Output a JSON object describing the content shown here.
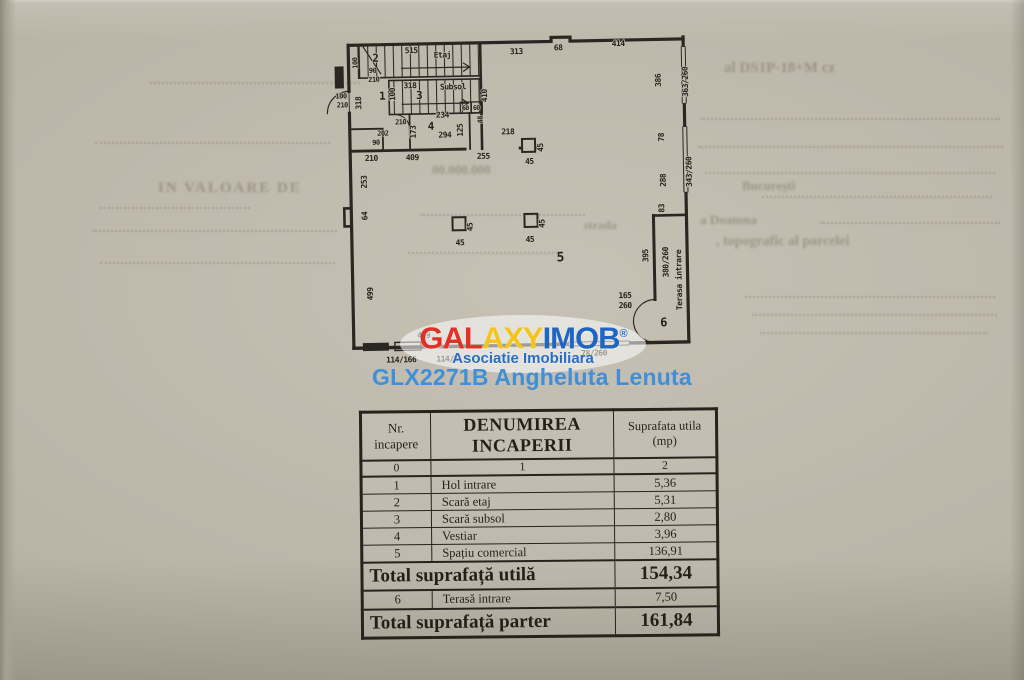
{
  "colors": {
    "paper": "#bcb6a9",
    "ink": "#26231d",
    "logo_gal": "#e03127",
    "logo_axy": "#f2c41d",
    "logo_imob": "#1f66c2",
    "tagline_blue": "#2b6cc4",
    "listing_blue": "#3f8fd9"
  },
  "watermark": {
    "logo_gal": "GAL",
    "logo_axy": "AXY",
    "logo_imob": "IMOB",
    "logo_reg": "®",
    "tagline": "Asociatie Imobiliara",
    "listing": "GLX2271B Angheluta Lenuta"
  },
  "table": {
    "headers": [
      "Nr.\nincapere",
      "DENUMIREA\nINCAPERII",
      "Suprafata utila\n(mp)"
    ],
    "index_row": [
      "0",
      "1",
      "2"
    ],
    "rows": [
      [
        "1",
        "Hol intrare",
        "5,36"
      ],
      [
        "2",
        "Scară etaj",
        "5,31"
      ],
      [
        "3",
        "Scară subsol",
        "2,80"
      ],
      [
        "4",
        "Vestiar",
        "3,96"
      ],
      [
        "5",
        "Spațiu comercial",
        "136,91"
      ]
    ],
    "total_utila": {
      "label": "Total suprafață utilă",
      "value": "154,34"
    },
    "terasa_row": [
      "6",
      "Terasă intrare",
      "7,50"
    ],
    "total_parter": {
      "label": "Total suprafață parter",
      "value": "161,84"
    }
  },
  "plan": {
    "labels": [
      {
        "t": "313",
        "x": 183,
        "y": 36
      },
      {
        "t": "68",
        "x": 225,
        "y": 33
      },
      {
        "t": "414",
        "x": 285,
        "y": 30
      },
      {
        "t": "386",
        "x": 327,
        "y": 65,
        "r": -90
      },
      {
        "t": "363/260",
        "x": 354,
        "y": 67,
        "r": -90
      },
      {
        "t": "78",
        "x": 329,
        "y": 122,
        "r": -90
      },
      {
        "t": "343/260",
        "x": 356,
        "y": 157,
        "r": -90
      },
      {
        "t": "288",
        "x": 330,
        "y": 165,
        "r": -90
      },
      {
        "t": "83",
        "x": 328,
        "y": 193,
        "r": -90
      },
      {
        "t": "395",
        "x": 311,
        "y": 240,
        "r": -90
      },
      {
        "t": "380/260",
        "x": 331,
        "y": 247,
        "r": -90
      },
      {
        "t": "Terasa intrare",
        "x": 344,
        "y": 265,
        "r": -90
      },
      {
        "t": "6",
        "x": 325,
        "y": 311,
        "s": 12
      },
      {
        "t": "165",
        "x": 287,
        "y": 282
      },
      {
        "t": "260",
        "x": 287,
        "y": 292
      },
      {
        "t": "5",
        "x": 223,
        "y": 244,
        "s": 13
      },
      {
        "t": "45",
        "x": 123,
        "y": 226
      },
      {
        "t": "45",
        "x": 136,
        "y": 208,
        "r": -90
      },
      {
        "t": "45",
        "x": 193,
        "y": 224
      },
      {
        "t": "45",
        "x": 208,
        "y": 206,
        "r": -90
      },
      {
        "t": "45",
        "x": 194,
        "y": 146
      },
      {
        "t": "45",
        "x": 208,
        "y": 130,
        "r": -90
      },
      {
        "t": "218",
        "x": 173,
        "y": 116
      },
      {
        "t": "255",
        "x": 148,
        "y": 140
      },
      {
        "t": "409",
        "x": 77,
        "y": 140
      },
      {
        "t": "210",
        "x": 36,
        "y": 140
      },
      {
        "t": "409",
        "x": 85,
        "y": 318
      },
      {
        "t": "253",
        "x": 31,
        "y": 161,
        "r": -90
      },
      {
        "t": "64",
        "x": 31,
        "y": 195,
        "r": -90
      },
      {
        "t": "499",
        "x": 35,
        "y": 273,
        "r": -90
      },
      {
        "t": "114/166",
        "x": 62,
        "y": 342
      },
      {
        "t": "114/1",
        "x": 108,
        "y": 342
      },
      {
        "t": "78/260",
        "x": 255,
        "y": 339
      },
      {
        "t": "410",
        "x": 153,
        "y": 77,
        "r": -90
      },
      {
        "t": "515",
        "x": 78,
        "y": 33
      },
      {
        "t": "Etaj",
        "x": 109,
        "y": 38
      },
      {
        "t": "2",
        "x": 42,
        "y": 41,
        "s": 11
      },
      {
        "t": "318",
        "x": 76,
        "y": 68
      },
      {
        "t": "Subsol",
        "x": 119,
        "y": 70
      },
      {
        "t": "3",
        "x": 85,
        "y": 79,
        "s": 11
      },
      {
        "t": "100",
        "x": 61,
        "y": 74,
        "r": -90
      },
      {
        "t": "1",
        "x": 48,
        "y": 79,
        "s": 11
      },
      {
        "t": "318",
        "x": 27,
        "y": 82,
        "r": -90
      },
      {
        "t": "100",
        "x": 7,
        "y": 77,
        "s": 7
      },
      {
        "t": "210",
        "x": 8,
        "y": 86,
        "s": 7
      },
      {
        "t": "100",
        "x": 24,
        "y": 42,
        "r": -90,
        "s": 7
      },
      {
        "t": "90",
        "x": 39,
        "y": 52,
        "s": 7
      },
      {
        "t": "210",
        "x": 40,
        "y": 61,
        "s": 7
      },
      {
        "t": "60",
        "x": 131,
        "y": 91,
        "s": 6.5
      },
      {
        "t": "60",
        "x": 142,
        "y": 91,
        "s": 6.5
      },
      {
        "t": "48",
        "x": 148,
        "y": 101,
        "r": -90,
        "s": 7
      },
      {
        "t": "210",
        "x": 66,
        "y": 104,
        "s": 7
      },
      {
        "t": "202",
        "x": 48,
        "y": 115,
        "s": 7
      },
      {
        "t": "90",
        "x": 41,
        "y": 124,
        "s": 7
      },
      {
        "t": "173",
        "x": 81,
        "y": 112,
        "r": -90
      },
      {
        "t": "234",
        "x": 108,
        "y": 98
      },
      {
        "t": "294",
        "x": 110,
        "y": 118
      },
      {
        "t": "4",
        "x": 96,
        "y": 110,
        "s": 11
      },
      {
        "t": "125",
        "x": 128,
        "y": 111,
        "r": -90
      }
    ]
  },
  "bleed": {
    "texts": [
      {
        "t": "al DS1P-18+M cz",
        "x": 724,
        "y": 60,
        "s": 15
      },
      {
        "t": "București",
        "x": 742,
        "y": 178,
        "s": 13
      },
      {
        "t": "a Doamna",
        "x": 700,
        "y": 212,
        "s": 13
      },
      {
        "t": "strada",
        "x": 584,
        "y": 218,
        "s": 12
      },
      {
        "t": ", topografic al parcelei",
        "x": 716,
        "y": 234,
        "s": 14
      },
      {
        "t": "IN VALOARE DE",
        "x": 158,
        "y": 180,
        "s": 15,
        "sp": 2
      },
      {
        "t": "00.000.000",
        "x": 432,
        "y": 162,
        "s": 13
      }
    ],
    "lines": [
      {
        "x": 150,
        "y": 82,
        "w": 210
      },
      {
        "x": 95,
        "y": 142,
        "w": 235
      },
      {
        "x": 100,
        "y": 207,
        "w": 150
      },
      {
        "x": 92,
        "y": 230,
        "w": 245
      },
      {
        "x": 100,
        "y": 262,
        "w": 235
      },
      {
        "x": 700,
        "y": 118,
        "w": 300
      },
      {
        "x": 698,
        "y": 146,
        "w": 305
      },
      {
        "x": 705,
        "y": 172,
        "w": 290
      },
      {
        "x": 762,
        "y": 196,
        "w": 230
      },
      {
        "x": 820,
        "y": 222,
        "w": 180
      },
      {
        "x": 745,
        "y": 296,
        "w": 250
      },
      {
        "x": 752,
        "y": 314,
        "w": 245
      },
      {
        "x": 760,
        "y": 332,
        "w": 228
      },
      {
        "x": 420,
        "y": 214,
        "w": 165
      },
      {
        "x": 408,
        "y": 252,
        "w": 150
      }
    ]
  }
}
